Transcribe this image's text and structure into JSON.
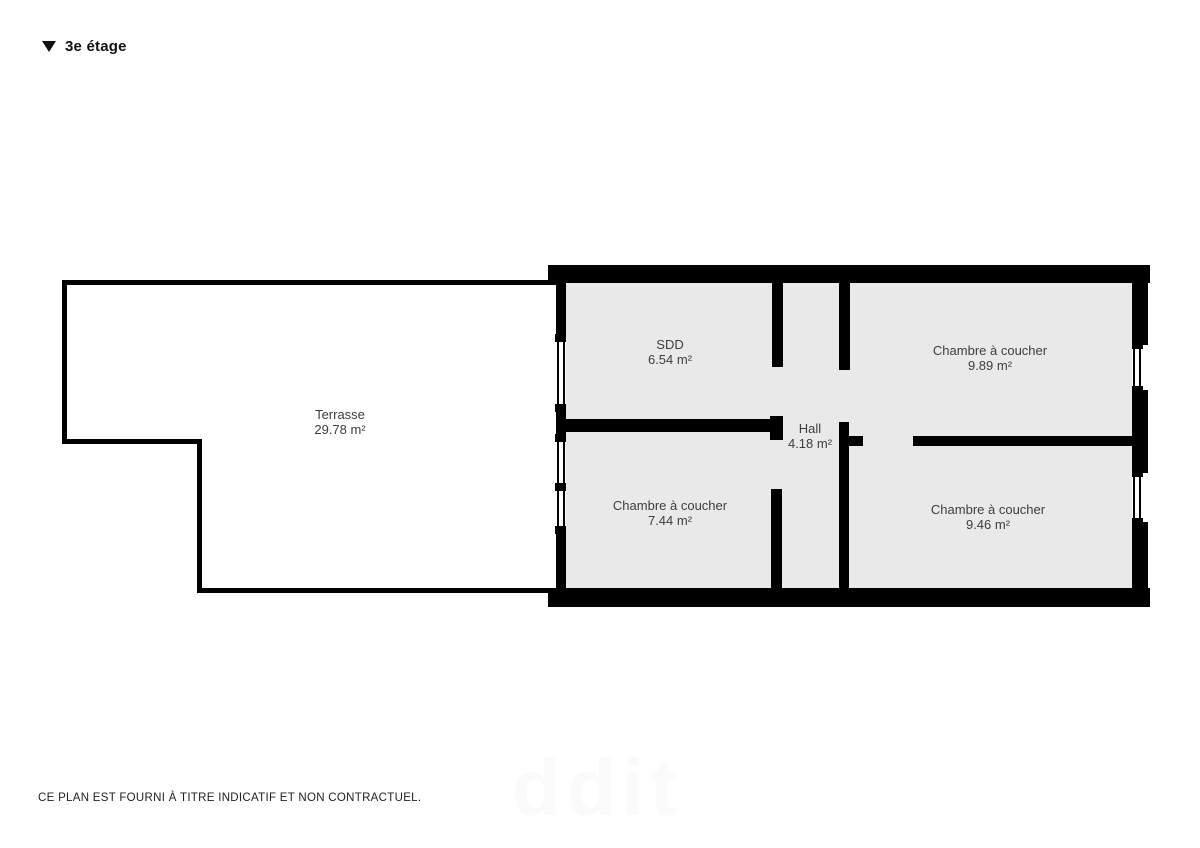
{
  "header": {
    "title": "3e étage",
    "marker_icon": "triangle-down-icon"
  },
  "rooms": [
    {
      "name": "Terrasse",
      "area": "29.78 m²"
    },
    {
      "name": "SDD",
      "area": "6.54 m²"
    },
    {
      "name": "Chambre à coucher",
      "area": "9.89 m²"
    },
    {
      "name": "Hall",
      "area": "4.18 m²"
    },
    {
      "name": "Chambre à coucher",
      "area": "7.44 m²"
    },
    {
      "name": "Chambre à coucher",
      "area": "9.46 m²"
    }
  ],
  "footer": {
    "disclaimer": "CE PLAN EST FOURNI À TITRE INDICATIF ET NON CONTRACTUEL."
  },
  "watermark": "ddit",
  "colors": {
    "wall": "#000000",
    "room_fill": "#e9e9e9",
    "terrace_fill": "#ffffff",
    "label_text": "#3d3d3d",
    "background": "#ffffff"
  }
}
